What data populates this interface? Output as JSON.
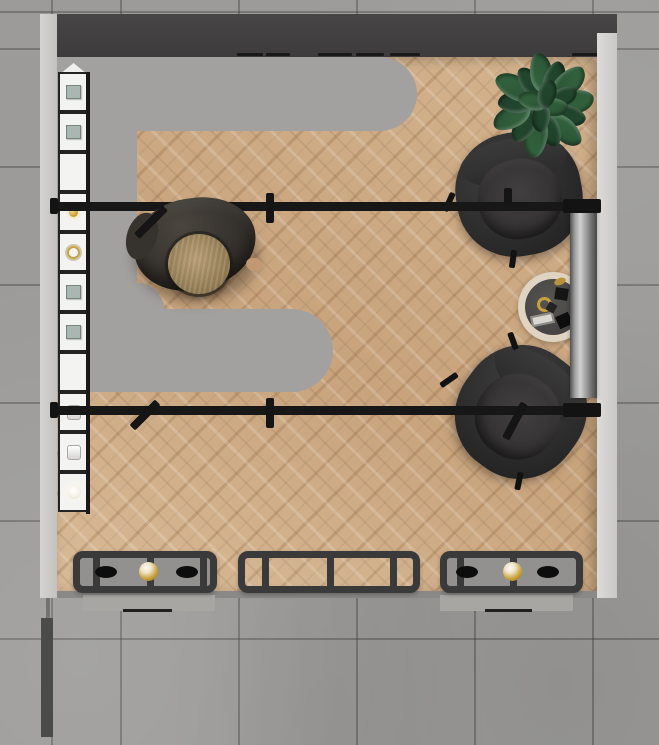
{
  "meta": {
    "view": "top-down interior render of a retail boutique",
    "canvas": {
      "width": 659,
      "height": 745
    }
  },
  "palette": {
    "concrete": "#9c9b99",
    "grout": "#3a3937",
    "wall_light": "#d0cfcd",
    "top_wall_band": "#413f3f",
    "counter_gray": "#a3a19f",
    "wood_floor": "#cfad89",
    "shelf_white": "#f3f3f1",
    "frame_black": "#232323",
    "rail_black": "#171717",
    "chair_charcoal": "#2b2a2a",
    "plant_greens": [
      "#2a5134",
      "#1d3e28",
      "#356740",
      "#244b30"
    ],
    "table_ring_cream": "#ded4c1",
    "table_top_gray": "#454442",
    "metal_silver": "#d0d0d0",
    "display_frame": "#3b3a3a",
    "display_glass_gray": "#929190",
    "gold": "#c9a23f",
    "skin": "#c39873",
    "hair": "#a58c66",
    "jacket": "#3b3835",
    "mat_gray": "#a8a6a3"
  },
  "scene": {
    "top_band": {
      "hangers": [
        {
          "x": 237,
          "w": 26
        },
        {
          "x": 266,
          "w": 24
        },
        {
          "x": 318,
          "w": 34
        },
        {
          "x": 356,
          "w": 28
        },
        {
          "x": 390,
          "w": 30
        },
        {
          "x": 572,
          "w": 28
        }
      ]
    },
    "shelf": {
      "items": [
        "cube",
        "cube",
        "none",
        "gold",
        "gold-ring",
        "cube",
        "cube",
        "none",
        "cylinder",
        "cylinder",
        "lamp"
      ]
    },
    "spotlights": [
      {
        "x": 151,
        "y": 222,
        "len": 40,
        "rot": 45
      },
      {
        "x": 270,
        "y": 208,
        "len": 30,
        "rot": 0
      },
      {
        "x": 508,
        "y": 196,
        "len": 16,
        "rot": 0
      },
      {
        "x": 145,
        "y": 415,
        "len": 36,
        "rot": 45
      },
      {
        "x": 270,
        "y": 413,
        "len": 30,
        "rot": 0
      },
      {
        "x": 515,
        "y": 421,
        "len": 40,
        "rot": 28
      }
    ],
    "plant": {
      "leaves": [
        {
          "a": 355,
          "d": 30,
          "w": 42,
          "h": 24
        },
        {
          "a": 22,
          "d": 27,
          "w": 36,
          "h": 20
        },
        {
          "a": 48,
          "d": 33,
          "w": 40,
          "h": 22
        },
        {
          "a": 75,
          "d": 26,
          "w": 34,
          "h": 20
        },
        {
          "a": 103,
          "d": 32,
          "w": 42,
          "h": 23
        },
        {
          "a": 130,
          "d": 28,
          "w": 36,
          "h": 20
        },
        {
          "a": 158,
          "d": 33,
          "w": 40,
          "h": 22
        },
        {
          "a": 186,
          "d": 27,
          "w": 36,
          "h": 21
        },
        {
          "a": 213,
          "d": 33,
          "w": 42,
          "h": 23
        },
        {
          "a": 240,
          "d": 26,
          "w": 34,
          "h": 19
        },
        {
          "a": 267,
          "d": 32,
          "w": 40,
          "h": 22
        },
        {
          "a": 294,
          "d": 28,
          "w": 36,
          "h": 20
        },
        {
          "a": 320,
          "d": 33,
          "w": 42,
          "h": 23
        },
        {
          "a": 338,
          "d": 22,
          "w": 30,
          "h": 18
        },
        {
          "a": 10,
          "d": 10,
          "w": 30,
          "h": 18
        },
        {
          "a": 100,
          "d": 12,
          "w": 30,
          "h": 18
        },
        {
          "a": 200,
          "d": 11,
          "w": 30,
          "h": 18
        },
        {
          "a": 290,
          "d": 12,
          "w": 30,
          "h": 18
        }
      ]
    },
    "display_tables": [
      {
        "x": 73,
        "w": 144,
        "top": "frosted",
        "dividers": [
          20,
          74,
          127
        ],
        "items": [
          {
            "type": "shoe",
            "cx": 33
          },
          {
            "type": "gold-sphere",
            "cx": 75
          },
          {
            "type": "shoe",
            "cx": 114
          }
        ]
      },
      {
        "x": 238,
        "w": 182,
        "top": "clear",
        "dividers": [
          24,
          89,
          152
        ],
        "items": []
      },
      {
        "x": 440,
        "w": 143,
        "top": "frosted",
        "dividers": [
          17,
          70
        ],
        "items": [
          {
            "type": "shoe",
            "cx": 27
          },
          {
            "type": "gold-sphere",
            "cx": 72
          },
          {
            "type": "shoe",
            "cx": 108
          }
        ]
      }
    ]
  }
}
